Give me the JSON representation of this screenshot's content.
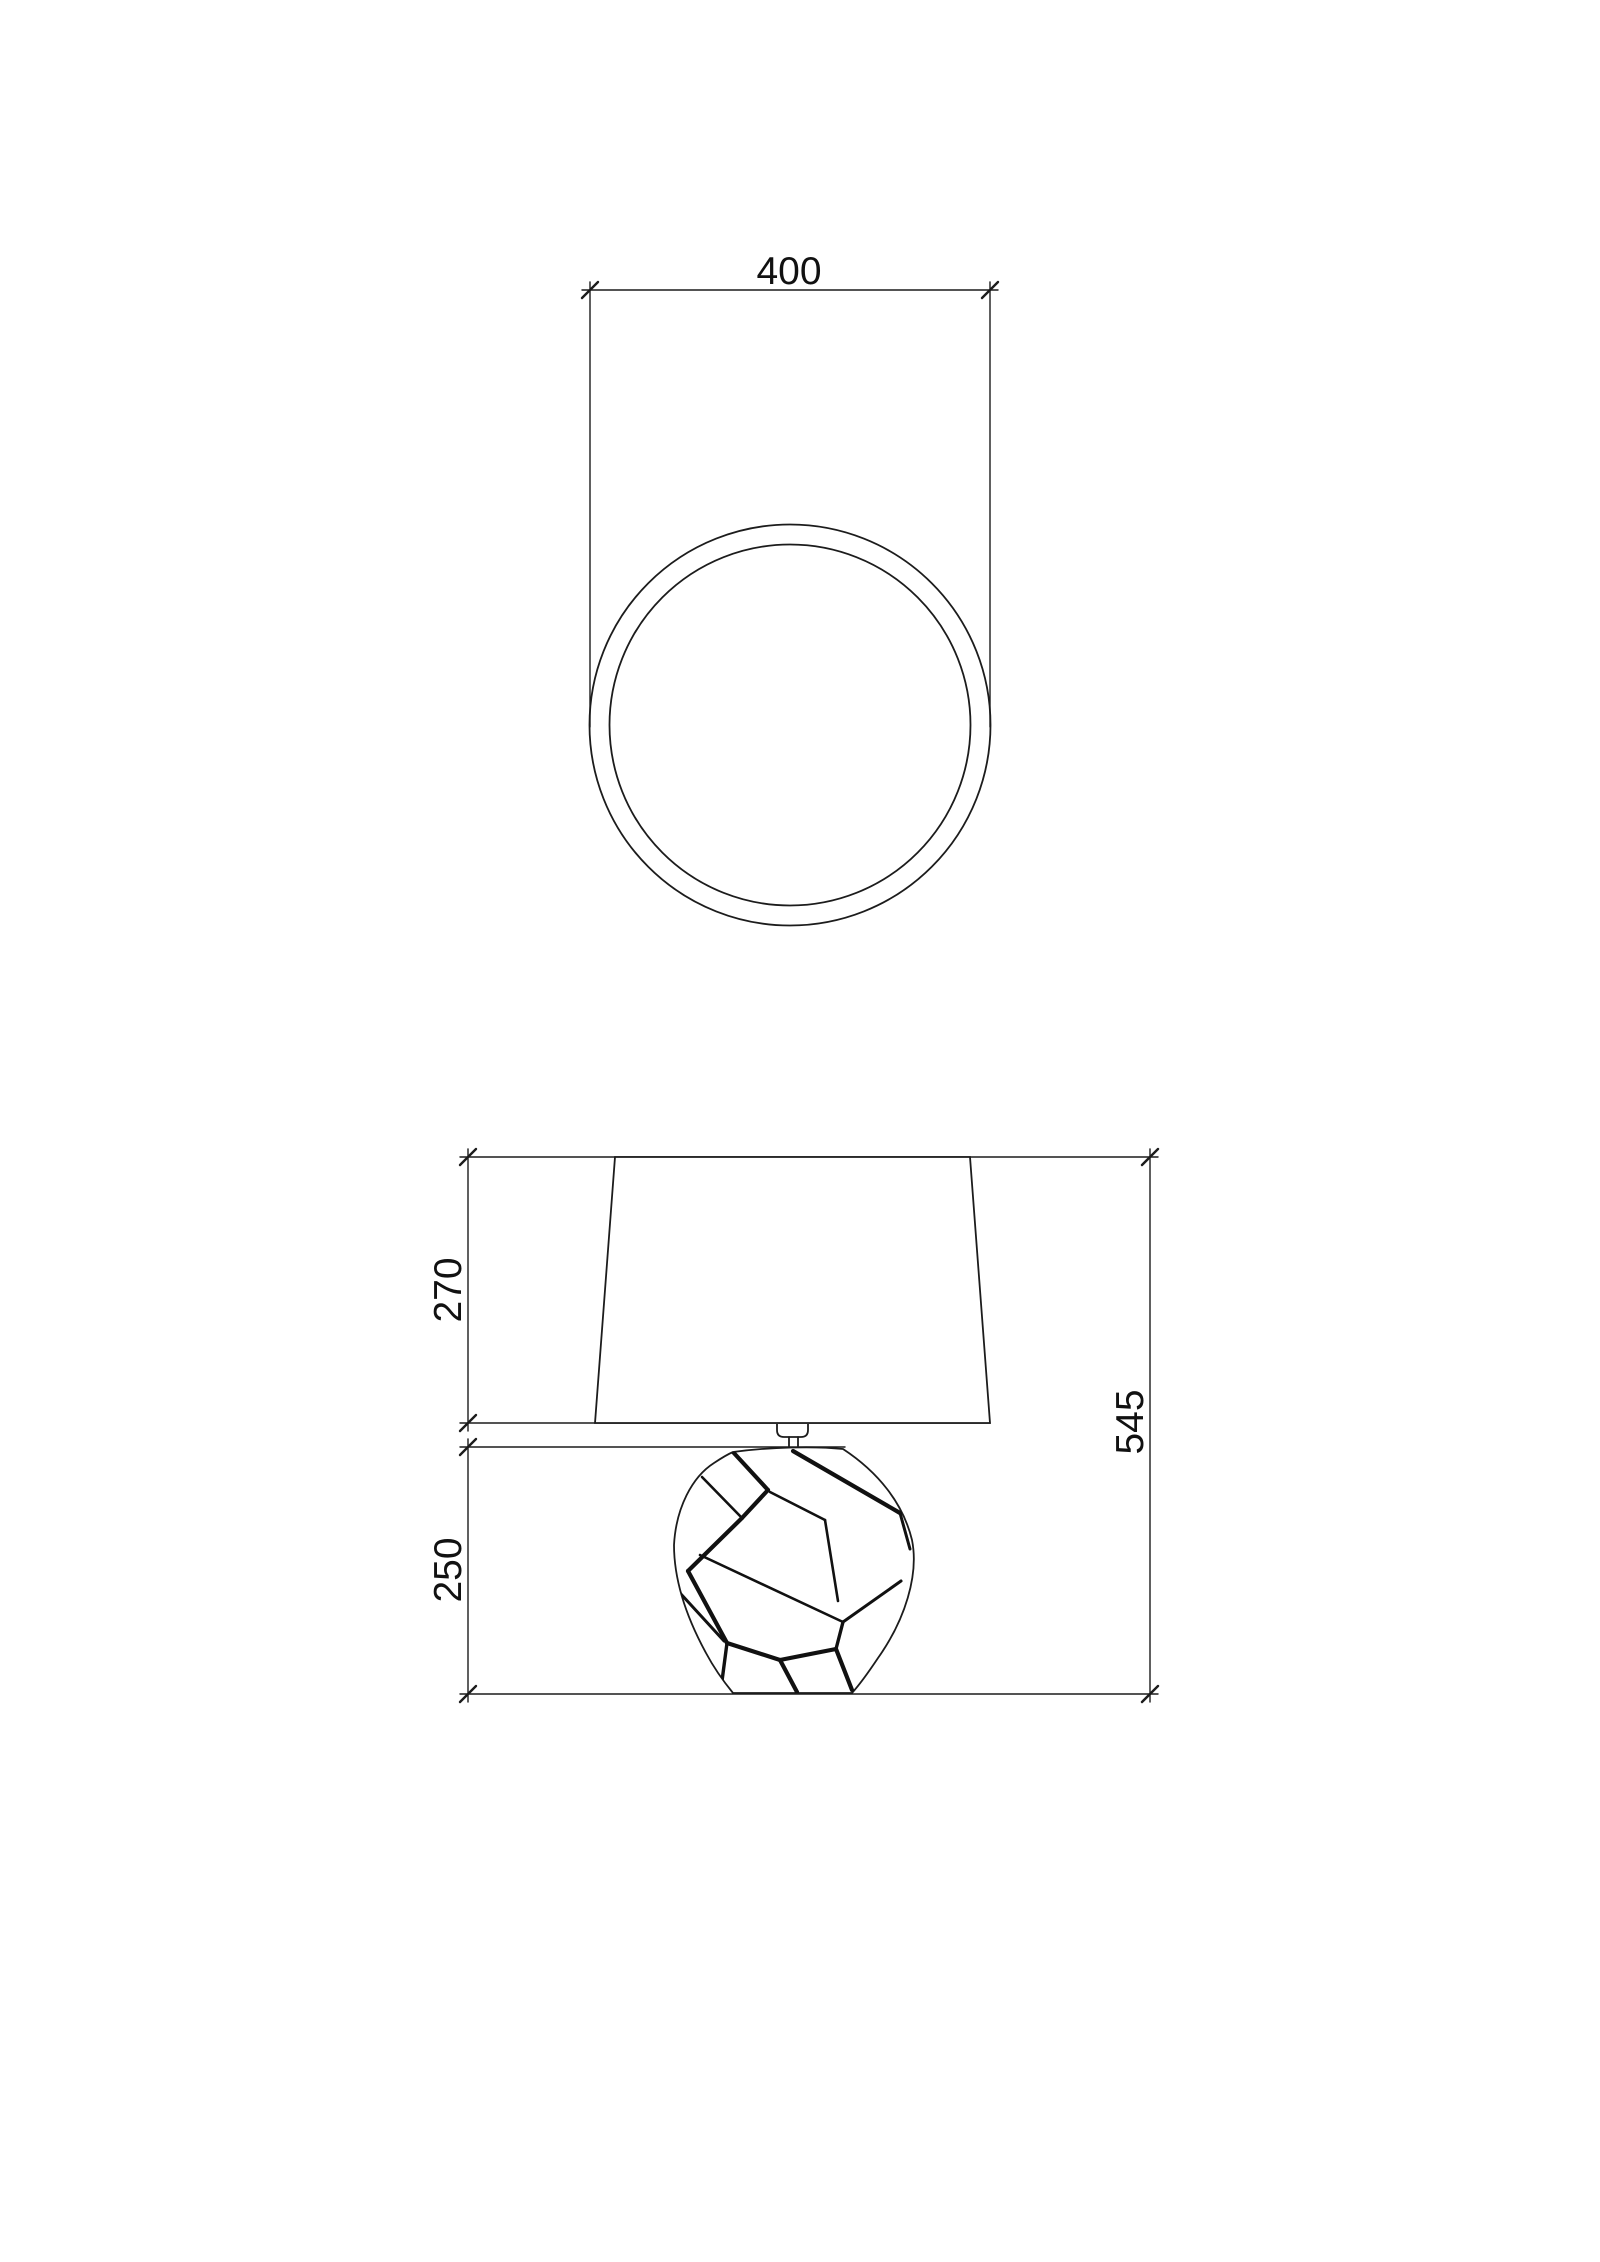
{
  "canvas": {
    "width": 1600,
    "height": 2262,
    "background": "#ffffff",
    "line_color": "#1c1c1c",
    "pattern_color": "#111111",
    "text_color": "#111111",
    "font_size": 39
  },
  "top_view": {
    "title": "lamp-shade-top-view",
    "dimension_label": "400",
    "label_anchor": {
      "x": 789,
      "y": 284,
      "rotate": 0
    },
    "dimension_line": {
      "x1": 582,
      "y1": 290,
      "x2": 998,
      "y2": 290
    },
    "extension_lines": [
      {
        "x1": 590,
        "y1": 282,
        "x2": 590,
        "y2": 727
      },
      {
        "x1": 990,
        "y1": 282,
        "x2": 990,
        "y2": 727
      }
    ],
    "ticks": [
      {
        "x": 590,
        "y": 290
      },
      {
        "x": 990,
        "y": 290
      }
    ],
    "outer_circle": {
      "cx": 790,
      "cy": 725,
      "r": 200.5
    },
    "inner_circle": {
      "cx": 790,
      "cy": 725,
      "r": 180.5
    }
  },
  "front_view": {
    "title": "lamp-front-view",
    "shade_polygon": "615,1157 970,1157 990,1423 595,1423",
    "finial_path": "M 777 1424 L 777 1430 Q 777 1437 784 1437 L 801 1437 Q 808 1437 808 1430 L 808 1424",
    "finial_stem_lines": [
      {
        "x1": 789,
        "y1": 1437,
        "x2": 789,
        "y2": 1448
      },
      {
        "x1": 798,
        "y1": 1437,
        "x2": 798,
        "y2": 1448
      }
    ],
    "vase_outline_path": "M 733 1452 C 770 1447 815 1446 843 1449 C 878 1472 903 1503 912 1540 C 919 1575 905 1620 878 1658 C 870 1670 861 1683 852 1693 L 733 1693 C 724 1682 714 1668 706 1653 C 688 1620 674 1583 674 1545 C 676 1508 692 1477 714 1463 C 720 1459 726 1455 733 1452 Z",
    "mosaic_segments": [
      {
        "x1": 793,
        "y1": 1451,
        "x2": 900,
        "y2": 1513,
        "w": 4.2
      },
      {
        "x1": 900,
        "y1": 1513,
        "x2": 910,
        "y2": 1549,
        "w": 3.0
      },
      {
        "x1": 733,
        "y1": 1452,
        "x2": 768,
        "y2": 1490,
        "w": 4.2
      },
      {
        "x1": 768,
        "y1": 1490,
        "x2": 742,
        "y2": 1518,
        "w": 4.2
      },
      {
        "x1": 742,
        "y1": 1518,
        "x2": 688,
        "y2": 1571,
        "w": 4.2
      },
      {
        "x1": 688,
        "y1": 1571,
        "x2": 727,
        "y2": 1643,
        "w": 4.2
      },
      {
        "x1": 727,
        "y1": 1643,
        "x2": 722,
        "y2": 1681,
        "w": 3.4
      },
      {
        "x1": 727,
        "y1": 1643,
        "x2": 780,
        "y2": 1660,
        "w": 4.2
      },
      {
        "x1": 780,
        "y1": 1660,
        "x2": 797,
        "y2": 1692,
        "w": 4.2
      },
      {
        "x1": 780,
        "y1": 1660,
        "x2": 836,
        "y2": 1649,
        "w": 4.2
      },
      {
        "x1": 836,
        "y1": 1649,
        "x2": 852,
        "y2": 1690,
        "w": 4.2
      },
      {
        "x1": 836,
        "y1": 1649,
        "x2": 843,
        "y2": 1622,
        "w": 3.4
      },
      {
        "x1": 843,
        "y1": 1622,
        "x2": 901,
        "y2": 1581,
        "w": 3.0
      },
      {
        "x1": 700,
        "y1": 1555,
        "x2": 843,
        "y2": 1622,
        "w": 2.6
      },
      {
        "x1": 825,
        "y1": 1520,
        "x2": 838,
        "y2": 1601,
        "w": 2.6
      },
      {
        "x1": 770,
        "y1": 1492,
        "x2": 825,
        "y2": 1520,
        "w": 2.6
      },
      {
        "x1": 702,
        "y1": 1477,
        "x2": 742,
        "y2": 1518,
        "w": 2.6
      },
      {
        "x1": 680,
        "y1": 1593,
        "x2": 724,
        "y2": 1641,
        "w": 3.0
      }
    ],
    "helper_lines": [
      {
        "name": "shade-top-extension-line",
        "x1": 460,
        "y1": 1157,
        "x2": 1158,
        "y2": 1157
      },
      {
        "name": "shade-bottom-extension-line",
        "x1": 460,
        "y1": 1423,
        "x2": 990,
        "y2": 1423
      },
      {
        "name": "base-top-extension-line",
        "x1": 460,
        "y1": 1447,
        "x2": 845,
        "y2": 1447
      },
      {
        "name": "ground-line",
        "x1": 460,
        "y1": 1694,
        "x2": 1158,
        "y2": 1694
      }
    ],
    "dimensions": [
      {
        "label": "270",
        "line": {
          "x1": 468,
          "y1": 1149,
          "x2": 468,
          "y2": 1431
        },
        "ticks": [
          {
            "x": 468,
            "y": 1157
          },
          {
            "x": 468,
            "y": 1423
          }
        ],
        "label_anchor": {
          "x": 461,
          "y": 1290,
          "rotate": -90
        }
      },
      {
        "label": "250",
        "line": {
          "x1": 468,
          "y1": 1439,
          "x2": 468,
          "y2": 1702
        },
        "ticks": [
          {
            "x": 468,
            "y": 1447
          },
          {
            "x": 468,
            "y": 1694
          }
        ],
        "label_anchor": {
          "x": 461,
          "y": 1570,
          "rotate": -90
        }
      },
      {
        "label": "545",
        "line": {
          "x1": 1150,
          "y1": 1149,
          "x2": 1150,
          "y2": 1702
        },
        "ticks": [
          {
            "x": 1150,
            "y": 1157
          },
          {
            "x": 1150,
            "y": 1694
          }
        ],
        "label_anchor": {
          "x": 1143,
          "y": 1422,
          "rotate": -90
        }
      }
    ]
  }
}
